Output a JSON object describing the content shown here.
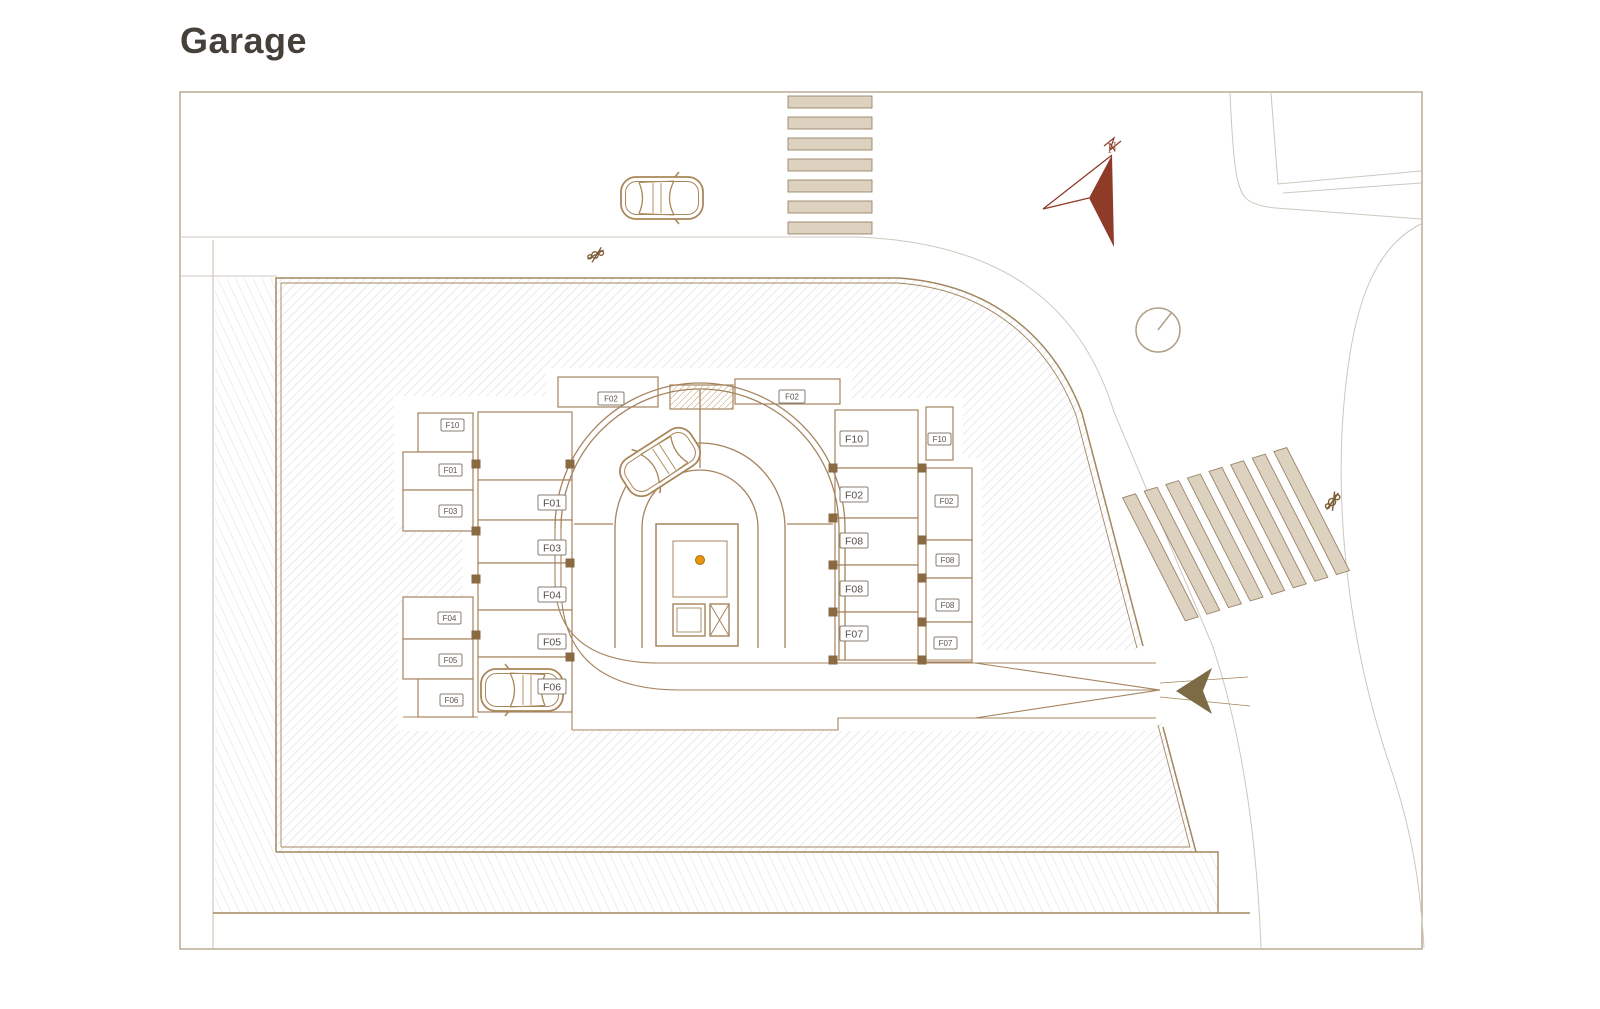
{
  "title": "Garage",
  "compass": {
    "north_label": "N"
  },
  "stalls": {
    "left_outer": [
      "F10",
      "F01",
      "F03",
      "F04",
      "F05",
      "F06"
    ],
    "left_inner": [
      "F01",
      "F03",
      "F04",
      "F05",
      "F06"
    ],
    "top": [
      "F02",
      "F02"
    ],
    "right_inner": [
      "F10",
      "F02",
      "F08",
      "F08",
      "F07"
    ],
    "right_outer": [
      "F10",
      "F02",
      "F08",
      "F08",
      "F07"
    ]
  },
  "colors": {
    "wall_brown": "#a5845f",
    "boundary_tan": "#a3875f",
    "site_hatch": "#dcdbe3",
    "outer_hatch": "#e2e0e6",
    "crosswalk_fill": "#ddd1c0",
    "crosswalk_stroke": "#9a8468",
    "north_arrow": "#8e3b28",
    "entrance_arrow": "#7d6b45",
    "column_dot_orange": "#e8940f",
    "road_gray": "#cdc7be",
    "title_text": "#454039"
  }
}
